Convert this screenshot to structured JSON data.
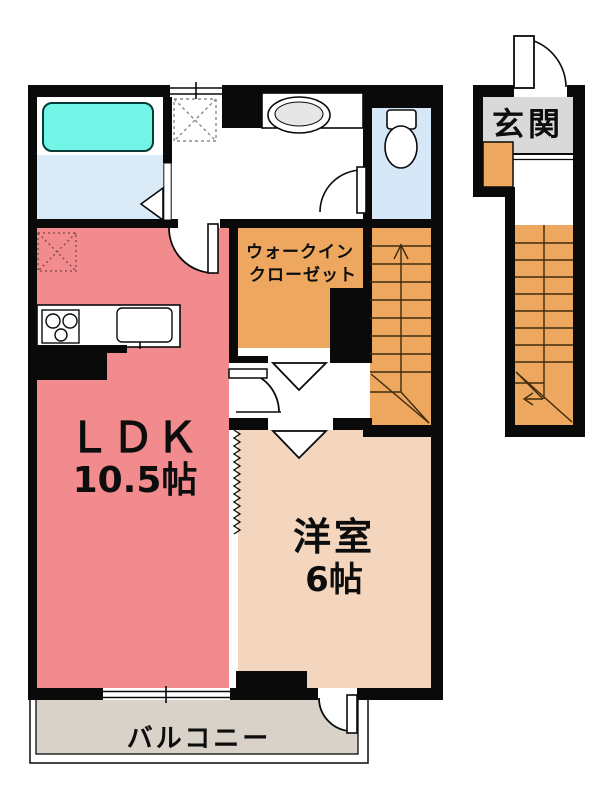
{
  "floorplan": {
    "title": "2F apartment floor plan",
    "rooms": {
      "ldk": {
        "label": "ＬＤＫ",
        "area": "10.5帖"
      },
      "bedroom": {
        "label": "洋室",
        "area": "6帖"
      },
      "walk_in_closet": {
        "label_line1": "ウォークイン",
        "label_line2": "クローゼット"
      },
      "entrance": {
        "label": "玄関"
      },
      "balcony": {
        "label": "バルコニー"
      }
    },
    "colors": {
      "wall": "#0a0a0a",
      "ldk_floor": "#f28b8d",
      "bedroom_floor": "#f3d6bd",
      "closet_and_stairs": "#eda75f",
      "bathroom_floor": "#dbeaf7",
      "toilet_floor": "#d6e8f7",
      "bathtub": "#72f5e6",
      "entrance_floor": "#d9d9d9",
      "balcony_floor": "#d8d2c9"
    }
  }
}
